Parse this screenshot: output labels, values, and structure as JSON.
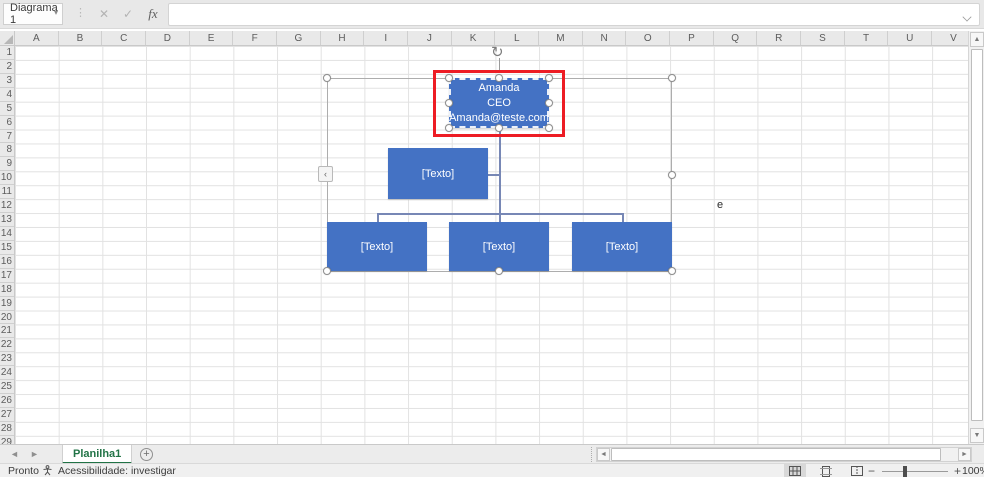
{
  "colors": {
    "accent_blue": "#4472C4",
    "connector": "#7787B5",
    "excel_green": "#217346",
    "annotation_red": "#ED1C24"
  },
  "formula_bar": {
    "name_box_value": "Diagrama 1",
    "cancel_icon": "✕",
    "confirm_icon": "✓",
    "function_label": "fx",
    "input_value": ""
  },
  "grid": {
    "columns": [
      "A",
      "B",
      "C",
      "D",
      "E",
      "F",
      "G",
      "H",
      "I",
      "J",
      "K",
      "L",
      "M",
      "N",
      "O",
      "P",
      "Q",
      "R",
      "S",
      "T",
      "U",
      "V"
    ],
    "rows": [
      "1",
      "2",
      "3",
      "4",
      "5",
      "6",
      "7",
      "8",
      "9",
      "10",
      "11",
      "12",
      "13",
      "14",
      "15",
      "16",
      "17",
      "18",
      "19",
      "20",
      "21",
      "22",
      "23",
      "24",
      "25",
      "26",
      "27",
      "28",
      "29"
    ],
    "cells": [
      {
        "text": "e"
      }
    ]
  },
  "smartart": {
    "root_lines": [
      "Amanda",
      "CEO",
      "Amanda@teste.com"
    ],
    "assistant_label": "[Texto]",
    "subordinate_labels": [
      "[Texto]",
      "[Texto]",
      "[Texto]"
    ]
  },
  "sheet_tabs": {
    "active": "Planilha1",
    "add_label": "+"
  },
  "status": {
    "mode": "Pronto",
    "accessibility": "Acessibilidade: investigar",
    "zoom": "100%"
  }
}
